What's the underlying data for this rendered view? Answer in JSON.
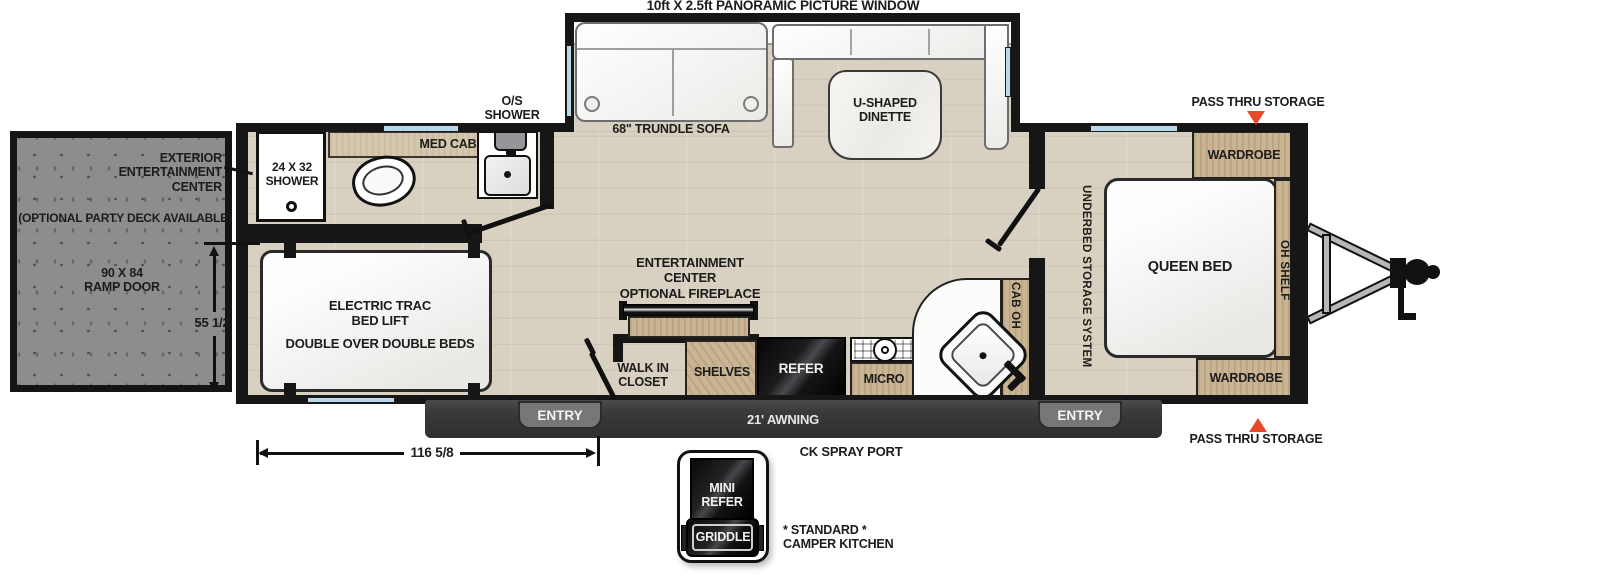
{
  "title": "10ft X 2.5ft PANORAMIC PICTURE WINDOW",
  "ramp": {
    "ext_ec_l1": "EXTERIOR",
    "ext_ec_l2": "ENTERTAINMENT",
    "ext_ec_l3": "CENTER",
    "party_deck": "(OPTIONAL PARTY DECK AVAILABLE)",
    "door_l1": "90 X 84",
    "door_l2": "RAMP DOOR",
    "dim_height": "55 1/2"
  },
  "garage": {
    "bed_l1": "ELECTRIC TRAC",
    "bed_l2": "BED LIFT",
    "bed_l3": "DOUBLE OVER DOUBLE BEDS"
  },
  "bathroom": {
    "shower_l1": "24 X 32",
    "shower_l2": "SHOWER",
    "med_cab": "MED CAB",
    "os_l1": "O/S",
    "os_l2": "SHOWER"
  },
  "living": {
    "sofa": "68\" TRUNDLE SOFA",
    "dinette_l1": "U-SHAPED",
    "dinette_l2": "DINETTE",
    "ec_l1": "ENTERTAINMENT",
    "ec_l2": "CENTER",
    "ec_l3": "OPTIONAL FIREPLACE",
    "closet_l1": "WALK IN",
    "closet_l2": "CLOSET",
    "shelves": "SHELVES"
  },
  "kitchen": {
    "refer": "REFER",
    "micro": "MICRO",
    "cab_oh": "CAB OH"
  },
  "bedroom": {
    "underbed": "UNDERBED STORAGE SYSTEM",
    "queen": "QUEEN BED",
    "wardrobe_top": "WARDROBE",
    "wardrobe_bottom": "WARDROBE",
    "oh_shelf": "OH SHELF"
  },
  "exterior": {
    "pass_thru_top": "PASS THRU STORAGE",
    "pass_thru_bottom": "PASS THRU STORAGE",
    "awning": "21' AWNING",
    "entry_left": "ENTRY",
    "entry_right": "ENTRY",
    "ck_spray_port": "CK SPRAY PORT",
    "dim_width": "116 5/8",
    "camper_kitchen": {
      "mini_l1": "MINI",
      "mini_l2": "REFER",
      "griddle": "GRIDDLE",
      "note_l1": "* STANDARD *",
      "note_l2": "CAMPER KITCHEN"
    }
  },
  "colors": {
    "accent_arrow": "#E8492A",
    "wall": "#161616",
    "floor": "#D8D1C2",
    "cabinet": "#C9B494",
    "ramp_door": "#8D8D8F",
    "awning_bar": "#3A3A3C",
    "entry_badge": "#77777A",
    "window": "#B9D9EA"
  }
}
